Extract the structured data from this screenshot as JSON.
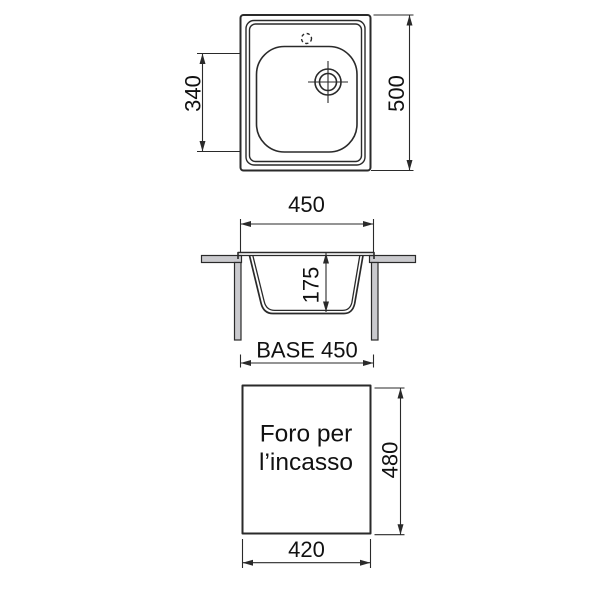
{
  "colors": {
    "line-color": "#2a2a2a",
    "counter-fill": "#cacace",
    "text-color": "#111111",
    "bg": "#ffffff"
  },
  "views": {
    "top": {
      "dim_340": "340",
      "dim_500": "500"
    },
    "section": {
      "dim_450": "450",
      "dim_175": "175",
      "dim_base": "BASE 450"
    },
    "cutout": {
      "line1": "Foro per",
      "line2": "l’incasso",
      "dim_480": "480",
      "dim_420": "420"
    }
  }
}
